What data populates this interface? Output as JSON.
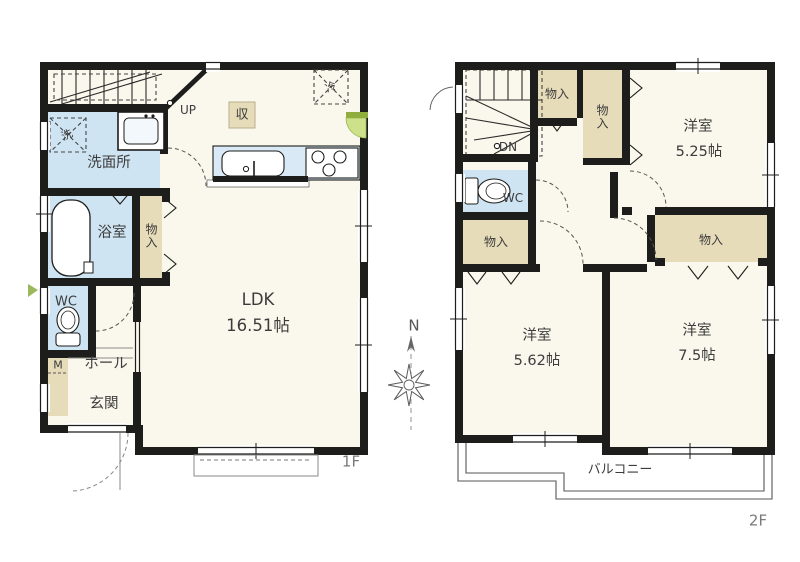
{
  "floor1": {
    "floor_label": "1F",
    "ldk": "LDK",
    "ldk_size": "16.51帖",
    "washroom": "洗面所",
    "bathroom": "浴室",
    "storage": "物入",
    "wc": "WC",
    "meter": "M",
    "hall": "ホール",
    "entrance": "玄関",
    "stairs_dir": "UP",
    "closet": "収",
    "laundry": "洗",
    "fridge": "冷"
  },
  "floor2": {
    "floor_label": "2F",
    "bedroom1": "洋室",
    "bedroom1_size": "5.25帖",
    "bedroom2": "洋室",
    "bedroom2_size": "5.62帖",
    "bedroom3": "洋室",
    "bedroom3_size": "7.5帖",
    "wc": "WC",
    "stairs_dir": "DN",
    "storage_a": "物入",
    "storage_b": "物入",
    "storage_c": "物入",
    "storage_d": "物入",
    "balcony": "バルコニー"
  },
  "compass": {
    "north": "N"
  },
  "colors": {
    "wall": "#1d1d1b",
    "wet_area": "#cfe4f2",
    "counter": "#d9eaf6",
    "storage_fill": "#e7dcba",
    "floor_fill": "#faf8ec",
    "door_green_light": "#cde08a",
    "door_green_dark": "#8fae3e"
  }
}
